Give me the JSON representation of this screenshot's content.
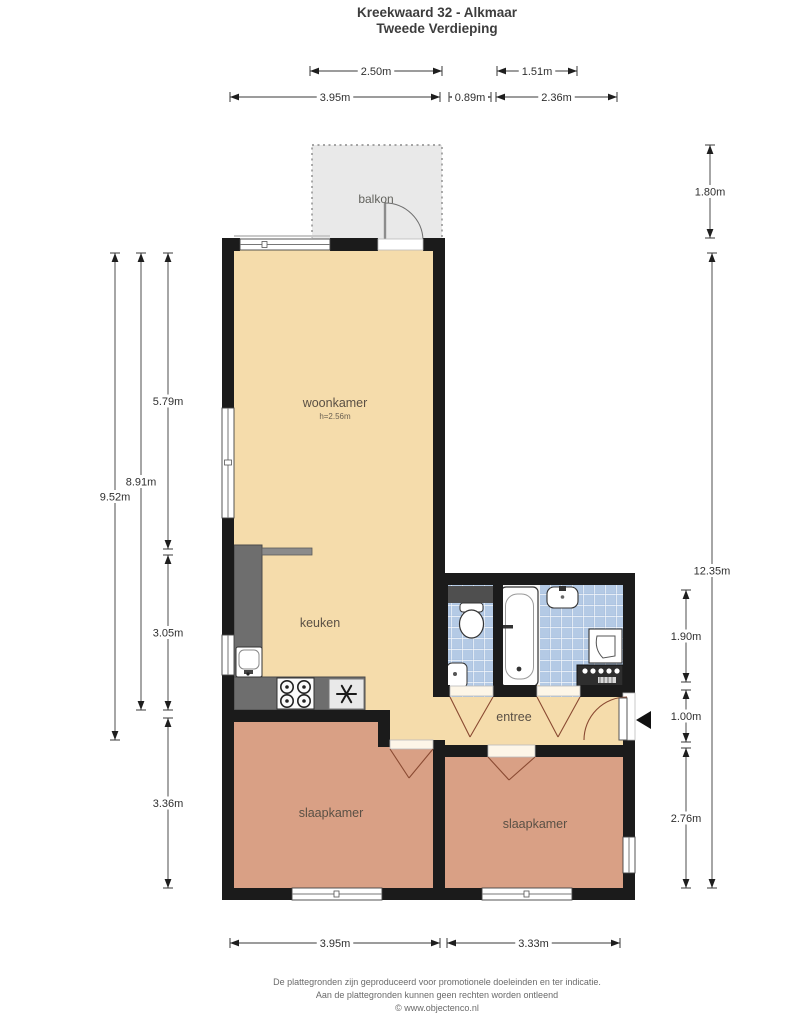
{
  "title": "Kreekwaard 32 - Alkmaar",
  "subtitle": "Tweede Verdieping",
  "rooms": {
    "balkon": "balkon",
    "woonkamer": "woonkamer",
    "woonkamer_height": "h=2.56m",
    "keuken": "keuken",
    "entree": "entree",
    "slaapkamer1": "slaapkamer",
    "slaapkamer2": "slaapkamer"
  },
  "dims": {
    "balkon_width": "2.50m",
    "bath_inner_width": "1.51m",
    "woonkamer_width": "3.95m",
    "wc_width": "0.89m",
    "bathroom_width": "2.36m",
    "slaapkamer1_width": "3.95m",
    "slaapkamer2_width": "3.33m",
    "left_total": "9.52m",
    "left_inner": "8.91m",
    "woonkamer_depth": "5.79m",
    "keuken_depth": "3.05m",
    "slaapkamer1_depth": "3.36m",
    "balkon_depth": "1.80m",
    "right_total": "12.35m",
    "bathroom_depth": "1.90m",
    "door_width": "1.00m",
    "slaapkamer2_depth": "2.76m"
  },
  "footer": {
    "line1": "De plattegronden zijn geproduceerd voor promotionele doeleinden en ter indicatie.",
    "line2": "Aan de plattegronden kunnen geen rechten worden ontleend",
    "line3": "© www.objectenco.nl"
  },
  "colors": {
    "wall": "#1b1b1b",
    "living_floor": "#f5dcab",
    "bedroom_floor": "#d9a085",
    "tile_base": "#b4cae5",
    "balcony_floor": "#e9e9e9",
    "counter": "#6e6e6e",
    "door_arc": "#8a4a32"
  }
}
